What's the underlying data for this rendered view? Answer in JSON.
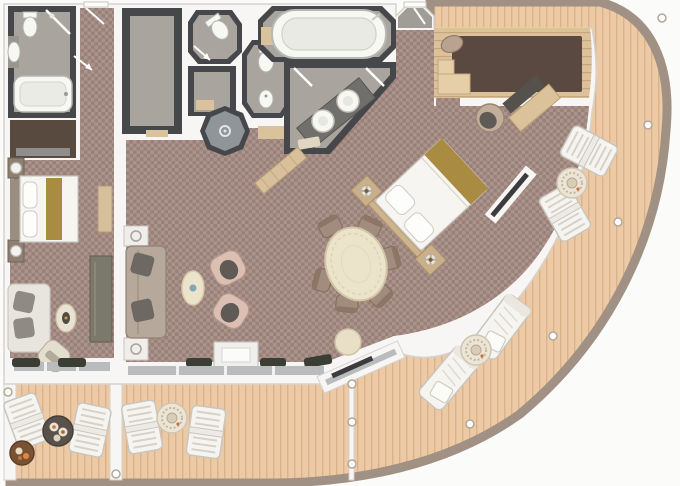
{
  "scene": {
    "type": "floor-plan",
    "subject": "luxury cruise suite with wrap-around balcony",
    "text_labels": []
  },
  "colors": {
    "bg": "#fbfbfa",
    "wall": "#f7f6f4",
    "wallLine": "#d5d3ce",
    "dark": "#46474b",
    "darkBrown": "#584a3f",
    "floorGrey": "#a9a49e",
    "floorBlue": "#90959a",
    "carpetA": "#ab948b",
    "carpetB": "#998078",
    "wood": "#dcc19b",
    "woodLine": "#c8a67c",
    "woodDark": "#594940",
    "deck": "#edcaa6",
    "deckLine": "#dcb28a",
    "rim": "#a09184",
    "glass": "#b9bcbc",
    "white": "#f5f4f0",
    "whiteStroke": "#c9c6be",
    "gold": "#a98b41",
    "sofa": "#b7a89c",
    "cushion": "#6e6862",
    "blush": "#dcbfb2",
    "blushSeat": "#5f5a56",
    "cream": "#ece3cb",
    "creamStroke": "#d2c5a6",
    "tableTaupe": "#a28c7d",
    "planter": "#3b3e35",
    "fixture": "#f7f7f3",
    "fixtureStroke": "#b5b5af",
    "marble": "#7b786c",
    "tan": "#d9c29c"
  },
  "rooms": [
    "guest-bathroom",
    "guest-wardrobe",
    "guest-entry-corridor",
    "guest-bedroom",
    "walk-in-wardrobe",
    "wc-room",
    "shower-room",
    "wc-bidet-room",
    "whirlpool-tub-room",
    "master-bathroom",
    "entrance-foyer",
    "master-walk-in-closet",
    "master-bedroom",
    "living-dining-area",
    "guest-balcony",
    "aft-balcony",
    "wrap-around-balcony"
  ],
  "fixtures": [
    "bathtub",
    "whirlpool-tub",
    "shower",
    "double-sink-vanity",
    "toilet",
    "bidet",
    "washbasin",
    "shower-drain"
  ],
  "furniture": [
    "double-bed",
    "king-bed",
    "nightstands",
    "sofa",
    "armchairs",
    "coffee-table",
    "side-table",
    "dining-table",
    "dining-chairs",
    "tv-console",
    "sideboard",
    "dresser",
    "vanity-desk",
    "vanity-chair",
    "ottoman",
    "deck-chairs",
    "sun-loungers",
    "deck-tables",
    "planters"
  ],
  "deck_items": [
    {
      "type": "deck-chair",
      "x": 27,
      "y": 421,
      "rot": -20
    },
    {
      "type": "deck-chair",
      "x": 90,
      "y": 430,
      "rot": 12
    },
    {
      "type": "table-dark",
      "x": 58,
      "y": 431,
      "rot": 0
    },
    {
      "type": "table-orange",
      "x": 22,
      "y": 453,
      "rot": 0
    },
    {
      "type": "deck-chair",
      "x": 142,
      "y": 427,
      "rot": -10
    },
    {
      "type": "deck-chair",
      "x": 206,
      "y": 432,
      "rot": 8
    },
    {
      "type": "table-mandala",
      "x": 172,
      "y": 418,
      "rot": 0
    },
    {
      "type": "deck-chair",
      "x": 589,
      "y": 151,
      "rot": -62
    },
    {
      "type": "deck-chair",
      "x": 565,
      "y": 213,
      "rot": -30
    },
    {
      "type": "table-mandala",
      "x": 572,
      "y": 183,
      "rot": 0
    },
    {
      "type": "lounger",
      "x": 501,
      "y": 327,
      "rot": 37
    },
    {
      "type": "lounger",
      "x": 449,
      "y": 378,
      "rot": 40
    },
    {
      "type": "table-mandala",
      "x": 476,
      "y": 350,
      "rot": 0
    }
  ],
  "dining_chairs": [
    {
      "x": 330,
      "y": 226,
      "rot": -30
    },
    {
      "x": 370,
      "y": 226,
      "rot": 25
    },
    {
      "x": 391,
      "y": 258,
      "rot": 75
    },
    {
      "x": 381,
      "y": 296,
      "rot": 135
    },
    {
      "x": 347,
      "y": 304,
      "rot": 185
    },
    {
      "x": 322,
      "y": 280,
      "rot": -75
    }
  ],
  "rail_posts": [
    {
      "x": 662,
      "y": 18
    },
    {
      "x": 648,
      "y": 125
    },
    {
      "x": 618,
      "y": 222
    },
    {
      "x": 553,
      "y": 336
    },
    {
      "x": 470,
      "y": 424
    },
    {
      "x": 352,
      "y": 384
    },
    {
      "x": 352,
      "y": 422
    },
    {
      "x": 352,
      "y": 464
    },
    {
      "x": 116,
      "y": 474
    },
    {
      "x": 8,
      "y": 392
    }
  ]
}
